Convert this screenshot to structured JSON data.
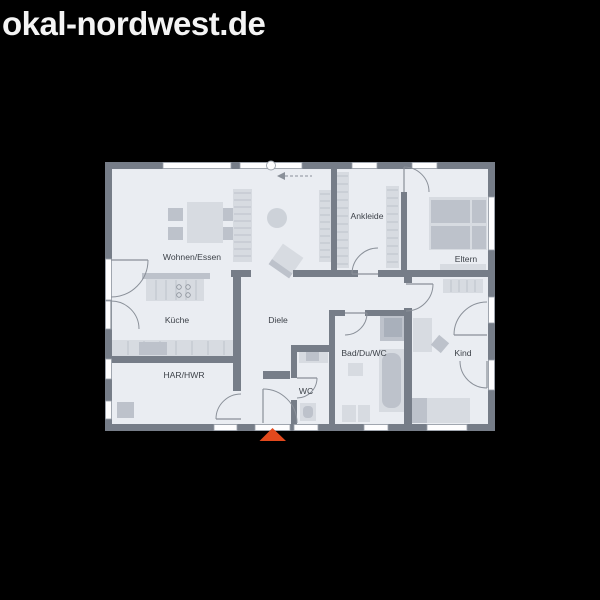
{
  "header": {
    "title": "okal-nordwest.de"
  },
  "colors": {
    "background": "#000000",
    "title": "#f4f4f4",
    "floor": "#eaedf2",
    "wall": "#767d88",
    "window": "#fdfdfe",
    "window_frame": "#9aa1aa",
    "door_arc": "#8a9099",
    "label": "#3d4249",
    "light": "#d7dbe1",
    "mid": "#bdc2cb",
    "dark": "#a9b0bb",
    "rug": "#cdd2d9",
    "stripe": "#b4b9c2",
    "burner": "#8a9099",
    "entrance_marker": "#e2491d"
  },
  "floorplan": {
    "floor": {
      "x": 105,
      "y": 162,
      "w": 390,
      "h": 269
    },
    "rooms": [
      {
        "label": "Wohnen/Essen",
        "x": 192,
        "y": 257
      },
      {
        "label": "Ankleide",
        "x": 367,
        "y": 216
      },
      {
        "label": "Eltern",
        "x": 466,
        "y": 259
      },
      {
        "label": "Küche",
        "x": 177,
        "y": 320
      },
      {
        "label": "Diele",
        "x": 278,
        "y": 320
      },
      {
        "label": "Bad/Du/WC",
        "x": 364,
        "y": 353
      },
      {
        "label": "Kind",
        "x": 463,
        "y": 353
      },
      {
        "label": "HAR/HWR",
        "x": 184,
        "y": 375
      },
      {
        "label": "WC",
        "x": 306,
        "y": 391
      }
    ],
    "walls": [
      [
        105,
        162,
        390,
        7
      ],
      [
        105,
        424,
        390,
        7
      ],
      [
        105,
        162,
        7,
        269
      ],
      [
        488,
        162,
        7,
        269
      ],
      [
        331,
        169,
        6,
        108
      ],
      [
        401,
        192,
        6,
        85
      ],
      [
        293,
        270,
        65,
        7
      ],
      [
        378,
        270,
        110,
        7
      ],
      [
        404,
        270,
        8,
        13
      ],
      [
        404,
        308,
        8,
        116
      ],
      [
        231,
        270,
        20,
        7
      ],
      [
        233,
        270,
        8,
        93
      ],
      [
        112,
        356,
        129,
        7
      ],
      [
        233,
        363,
        8,
        28
      ],
      [
        291,
        345,
        42,
        7
      ],
      [
        291,
        352,
        6,
        26
      ],
      [
        291,
        400,
        6,
        24
      ],
      [
        263,
        371,
        27,
        8
      ],
      [
        329,
        310,
        6,
        114
      ],
      [
        333,
        310,
        12,
        6
      ],
      [
        365,
        310,
        40,
        6
      ]
    ],
    "windows": [
      [
        163,
        162.5,
        68,
        6
      ],
      [
        240,
        162.5,
        62,
        6
      ],
      [
        352,
        162.5,
        25,
        6
      ],
      [
        412,
        162.5,
        25,
        6
      ],
      [
        488.5,
        197,
        6,
        53
      ],
      [
        488.5,
        297,
        6,
        26
      ],
      [
        488.5,
        360,
        6,
        30
      ],
      [
        214,
        424.5,
        23,
        6
      ],
      [
        255,
        424.5,
        35,
        6
      ],
      [
        294,
        424.5,
        24,
        6
      ],
      [
        364,
        424.5,
        24,
        6
      ],
      [
        427,
        424.5,
        40,
        6
      ],
      [
        105.5,
        259,
        6,
        41
      ],
      [
        105.5,
        301,
        6,
        28
      ],
      [
        105.5,
        359,
        6,
        20
      ],
      [
        105.5,
        401,
        6,
        18
      ]
    ],
    "doors": [
      {
        "n": "door-terrace-wohnen",
        "cx": 111,
        "cy": 260,
        "r": 37,
        "a": 0
      },
      {
        "n": "door-terrace-kueche",
        "cx": 111,
        "cy": 329,
        "r": 28,
        "a": 270
      },
      {
        "n": "door-har-hwr",
        "cx": 241,
        "cy": 419,
        "r": 25,
        "a": 180
      },
      {
        "n": "door-entrance",
        "cx": 263,
        "cy": 423,
        "r": 34,
        "a": 270
      },
      {
        "n": "door-wc",
        "cx": 297,
        "cy": 378,
        "r": 20,
        "a": 0
      },
      {
        "n": "door-bad",
        "cx": 345,
        "cy": 313,
        "r": 22,
        "a": 0
      },
      {
        "n": "door-ankleide",
        "cx": 378,
        "cy": 274,
        "r": 26,
        "a": 180
      },
      {
        "n": "door-eltern",
        "cx": 404,
        "cy": 192,
        "r": 25,
        "a": 270
      },
      {
        "n": "door-kind",
        "cx": 406,
        "cy": 284,
        "r": 27,
        "a": 0
      },
      {
        "n": "door-terrace-kind-upper",
        "cx": 487,
        "cy": 335,
        "r": 33,
        "a": 180
      },
      {
        "n": "door-terrace-kind-lower",
        "cx": 487,
        "cy": 361,
        "r": 27,
        "a": 90
      }
    ],
    "furniture": [
      {
        "n": "dining-chair",
        "t": "rect",
        "x": 168,
        "y": 208,
        "w": 15,
        "h": 13,
        "c": "mid"
      },
      {
        "n": "dining-chair",
        "t": "rect",
        "x": 168,
        "y": 227,
        "w": 15,
        "h": 13,
        "c": "mid"
      },
      {
        "n": "dining-chair",
        "t": "rect",
        "x": 223,
        "y": 208,
        "w": 15,
        "h": 13,
        "c": "mid"
      },
      {
        "n": "dining-chair",
        "t": "rect",
        "x": 223,
        "y": 227,
        "w": 15,
        "h": 13,
        "c": "mid"
      },
      {
        "n": "dining-table",
        "t": "rect",
        "x": 187,
        "y": 202,
        "w": 36,
        "h": 41,
        "c": "light"
      },
      {
        "n": "living-shelf",
        "t": "rect",
        "x": 233,
        "y": 189,
        "w": 19,
        "h": 73,
        "c": "light",
        "stripes": "h",
        "gap": 7
      },
      {
        "n": "living-cabinet",
        "t": "rect",
        "x": 319,
        "y": 190,
        "w": 12,
        "h": 72,
        "c": "light",
        "stripes": "h",
        "gap": 7
      },
      {
        "n": "round-rug",
        "t": "circle",
        "cx": 277,
        "cy": 218,
        "r": 10,
        "c": "rug"
      },
      {
        "n": "armchair",
        "t": "rot",
        "cx": 286,
        "cy": 261,
        "w": 25,
        "h": 25,
        "a": 35,
        "c": "light",
        "strip": true
      },
      {
        "n": "wardrobe-ankleide-left",
        "t": "rect",
        "x": 334,
        "y": 172,
        "w": 15,
        "h": 96,
        "c": "light",
        "stripes": "h",
        "gap": 8
      },
      {
        "n": "wardrobe-ankleide-right",
        "t": "rect",
        "x": 386,
        "y": 186,
        "w": 13,
        "h": 82,
        "c": "light",
        "stripes": "h",
        "gap": 8
      },
      {
        "n": "bed-parents",
        "t": "rect",
        "x": 429,
        "y": 197,
        "w": 58,
        "h": 53,
        "c": "light"
      },
      {
        "n": "mattress-parents",
        "t": "rect",
        "x": 431,
        "y": 200,
        "w": 39,
        "h": 23,
        "c": "mid"
      },
      {
        "n": "mattress-parents",
        "t": "rect",
        "x": 431,
        "y": 226,
        "w": 39,
        "h": 23,
        "c": "mid"
      },
      {
        "n": "pillow-parents",
        "t": "rect",
        "x": 472,
        "y": 200,
        "w": 14,
        "h": 23,
        "c": "mid"
      },
      {
        "n": "pillow-parents",
        "t": "rect",
        "x": 472,
        "y": 226,
        "w": 14,
        "h": 23,
        "c": "mid"
      },
      {
        "n": "sideboard-parents",
        "t": "rect",
        "x": 440,
        "y": 264,
        "w": 46,
        "h": 8,
        "c": "light"
      },
      {
        "n": "kitchen-island-bar",
        "t": "rect",
        "x": 142,
        "y": 273,
        "w": 68,
        "h": 6,
        "c": "mid"
      },
      {
        "n": "kitchen-island",
        "t": "rect",
        "x": 146,
        "y": 279,
        "w": 58,
        "h": 22,
        "c": "light",
        "stripes": "v",
        "gap": 10
      },
      {
        "n": "stove-burner",
        "t": "ring",
        "cx": 179,
        "cy": 287,
        "r": 2.3
      },
      {
        "n": "stove-burner",
        "t": "ring",
        "cx": 188,
        "cy": 287,
        "r": 2.3
      },
      {
        "n": "stove-burner",
        "t": "ring",
        "cx": 179,
        "cy": 295,
        "r": 2.3
      },
      {
        "n": "stove-burner",
        "t": "ring",
        "cx": 188,
        "cy": 295,
        "r": 2.3
      },
      {
        "n": "kitchen-counter",
        "t": "rect",
        "x": 112,
        "y": 340,
        "w": 128,
        "h": 16,
        "c": "light",
        "stripes": "v",
        "gap": 16
      },
      {
        "n": "kitchen-appliance",
        "t": "rect",
        "x": 139,
        "y": 342,
        "w": 28,
        "h": 13,
        "c": "mid"
      },
      {
        "n": "har-appliance",
        "t": "rect",
        "x": 117,
        "y": 402,
        "w": 17,
        "h": 16,
        "c": "mid"
      },
      {
        "n": "wc-sink",
        "t": "rect",
        "x": 299,
        "y": 347,
        "w": 29,
        "h": 16,
        "c": "light"
      },
      {
        "n": "wc-sink-basin",
        "t": "rect",
        "x": 306,
        "y": 350,
        "w": 13,
        "h": 11,
        "c": "mid"
      },
      {
        "n": "wc-toilet",
        "t": "rect",
        "x": 300,
        "y": 403,
        "w": 16,
        "h": 18,
        "c": "light"
      },
      {
        "n": "wc-toilet-seat",
        "t": "rect",
        "x": 303,
        "y": 406,
        "w": 10,
        "h": 12,
        "c": "mid",
        "rx": 4
      },
      {
        "n": "shower",
        "t": "rect",
        "x": 380,
        "y": 314,
        "w": 26,
        "h": 27,
        "c": "mid"
      },
      {
        "n": "shower-tray",
        "t": "rect",
        "x": 384,
        "y": 318,
        "w": 18,
        "h": 19,
        "c": "dark"
      },
      {
        "n": "bathtub",
        "t": "rect",
        "x": 379,
        "y": 349,
        "w": 25,
        "h": 63,
        "c": "light"
      },
      {
        "n": "bathtub-inner",
        "t": "rect",
        "x": 382,
        "y": 353,
        "w": 19,
        "h": 55,
        "c": "mid",
        "rx": 8
      },
      {
        "n": "bath-sink",
        "t": "rect",
        "x": 348,
        "y": 363,
        "w": 15,
        "h": 13,
        "c": "light"
      },
      {
        "n": "bath-toilet",
        "t": "rect",
        "x": 342,
        "y": 405,
        "w": 14,
        "h": 17,
        "c": "light"
      },
      {
        "n": "bath-bidet",
        "t": "rect",
        "x": 358,
        "y": 405,
        "w": 12,
        "h": 17,
        "c": "light"
      },
      {
        "n": "wardrobe-kind",
        "t": "rect",
        "x": 443,
        "y": 279,
        "w": 40,
        "h": 14,
        "c": "light",
        "stripes": "v",
        "gap": 8
      },
      {
        "n": "desk-kind",
        "t": "rect",
        "x": 413,
        "y": 318,
        "w": 19,
        "h": 34,
        "c": "light"
      },
      {
        "n": "chair-kind",
        "t": "rot",
        "cx": 440,
        "cy": 344,
        "w": 13,
        "h": 13,
        "a": 40,
        "c": "mid"
      },
      {
        "n": "bed-kind-pillow",
        "t": "rect",
        "x": 409,
        "y": 398,
        "w": 18,
        "h": 25,
        "c": "mid"
      },
      {
        "n": "bed-kind",
        "t": "rect",
        "x": 427,
        "y": 398,
        "w": 43,
        "h": 25,
        "c": "light"
      }
    ],
    "window_circle": {
      "cx": 271,
      "cy": 165.5,
      "r": 4.5
    },
    "slide_arrow": {
      "tip_x": 277,
      "tip_y": 176,
      "tail_x": 312,
      "half": 4
    },
    "entrance_marker": {
      "points": "259.5,441 286,441 272.5,428"
    }
  }
}
